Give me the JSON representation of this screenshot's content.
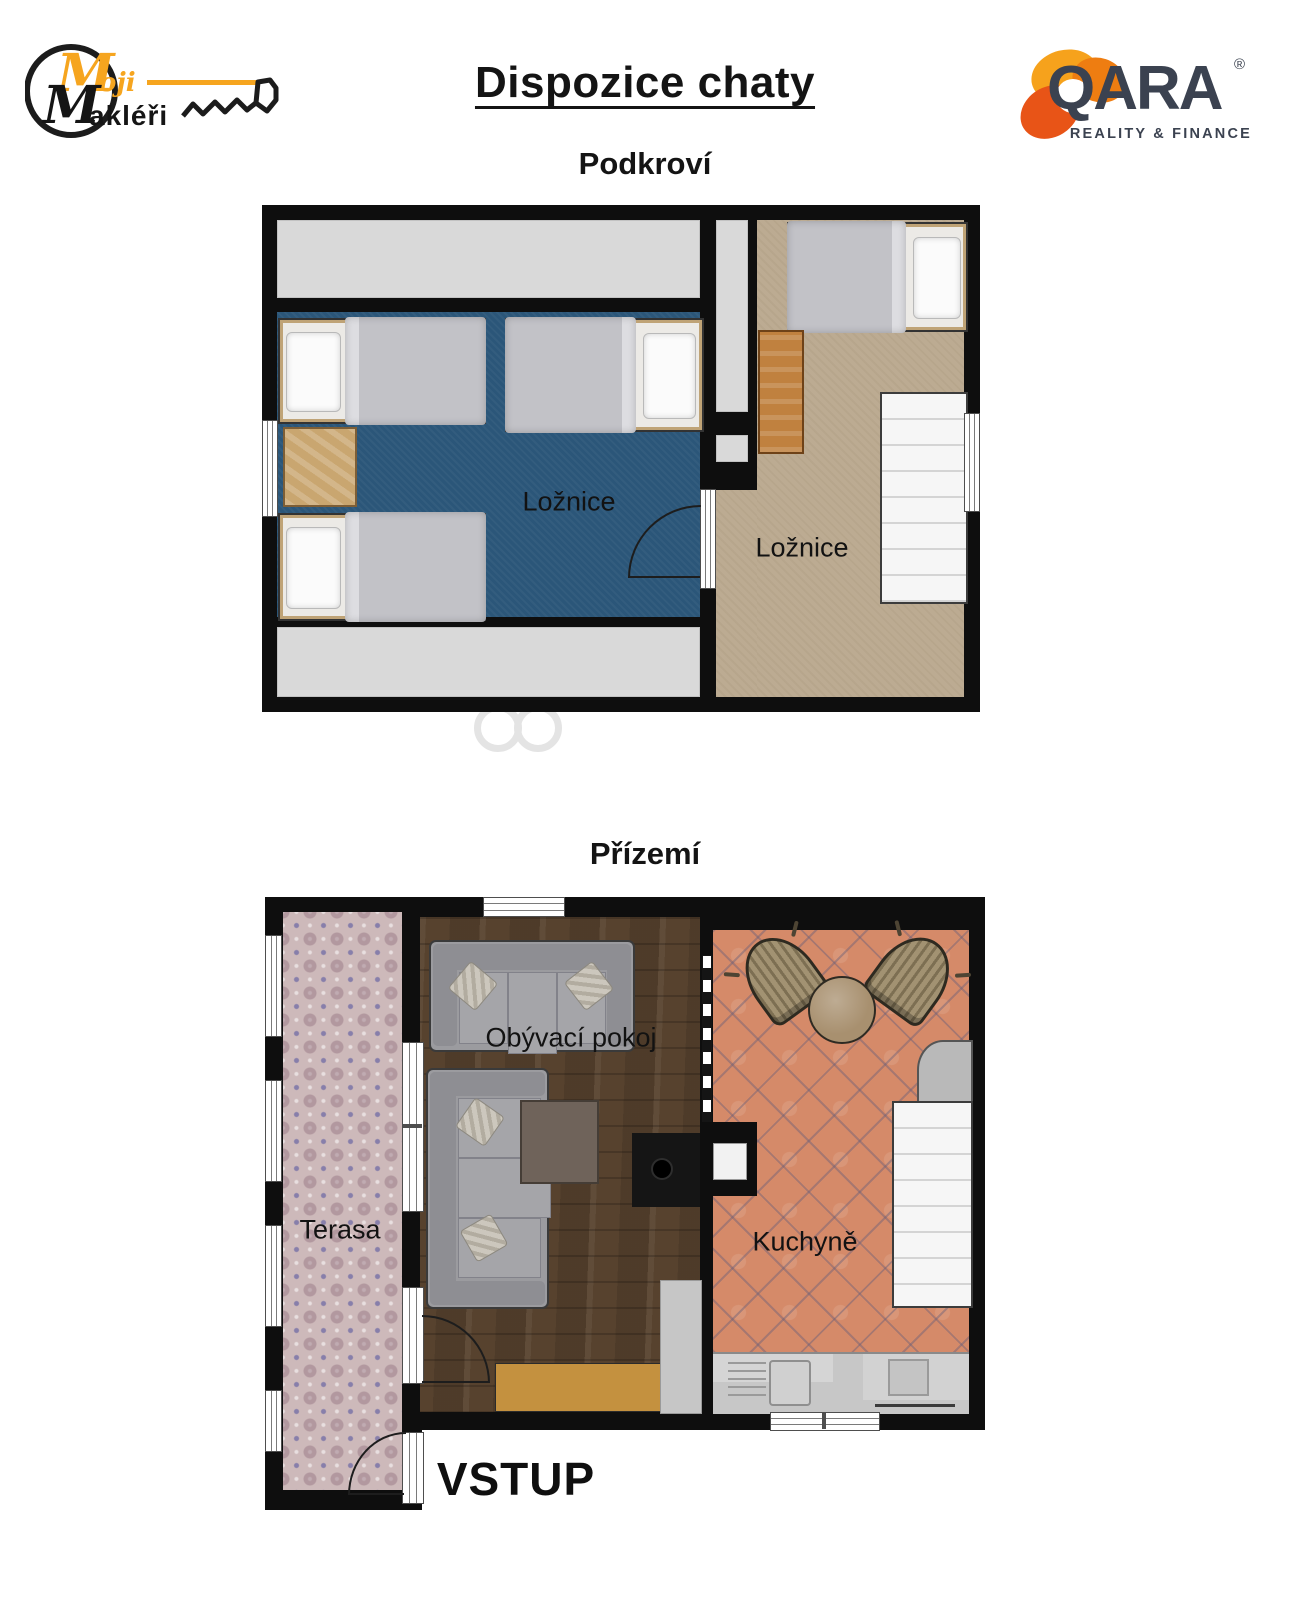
{
  "header": {
    "title": "Dispozice chaty",
    "attic_title": "Podkroví",
    "ground_title": "Přízemí"
  },
  "logo_left": {
    "name": "Moji Makléři",
    "monogram_top": "M",
    "script_top": "oji",
    "monogram_bottom": "M",
    "script_bottom": "akléři",
    "icon": "key-icon"
  },
  "logo_right": {
    "brand": "QARA",
    "registered": "®",
    "tagline": "REALITY & FINANCE",
    "icon": "citrus-blossom-icon"
  },
  "attic": {
    "bedroom_left_label": "Ložnice",
    "bedroom_right_label": "Ložnice"
  },
  "ground": {
    "living_room_label": "Obývací pokoj",
    "kitchen_label": "Kuchyně",
    "terrace_label": "Terasa",
    "entrance_label": "VSTUP"
  },
  "colors": {
    "wall": "#0e0e0e",
    "bedroom_left_floor": "#2b5679",
    "bedroom_right_floor": "#bcab92",
    "attic_void": "#d9d9d9",
    "living_room_floor": "#57422e",
    "kitchen_floor": "#d58a69",
    "terrace_floor": "#cdb9ba",
    "rug": "#c4913f",
    "stairs": "#f6f6f6",
    "accent_orange": "#f6a51f",
    "brand_navy": "#3b4250"
  }
}
